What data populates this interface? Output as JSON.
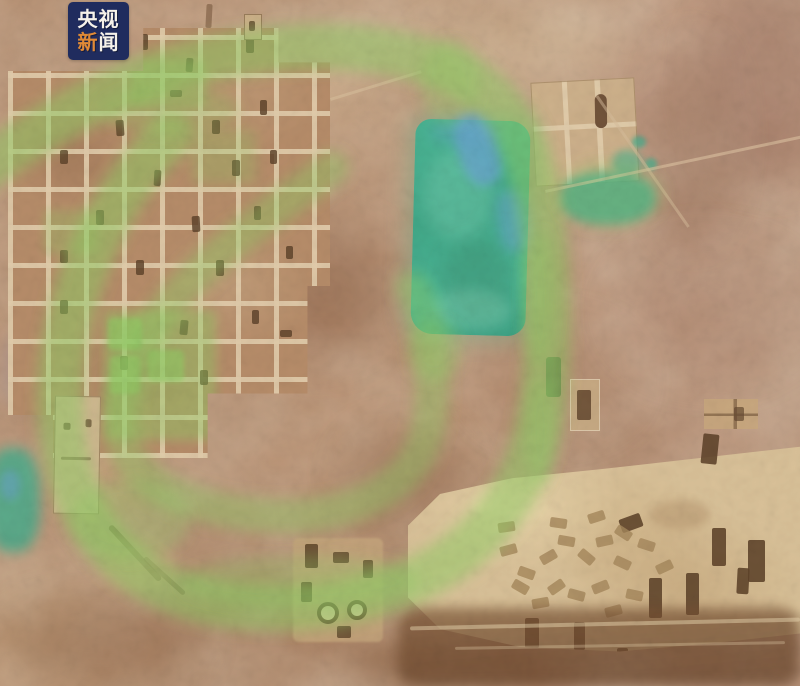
{
  "logo_badge": {
    "line1": "央视",
    "line2_char1": "新",
    "line2_char2": "闻"
  },
  "colors": {
    "badge_bg": "#202c5e",
    "badge_text": "#f6f2ea",
    "badge_accent": "#e08a36",
    "highlight_green": "#8fcd63",
    "pond_teal": "#43ac8c",
    "pond_blue": "#69a3ce",
    "terrain_base": "#b58a6b",
    "field_tan": "#d9c198",
    "feature_dark": "#5d4229"
  }
}
